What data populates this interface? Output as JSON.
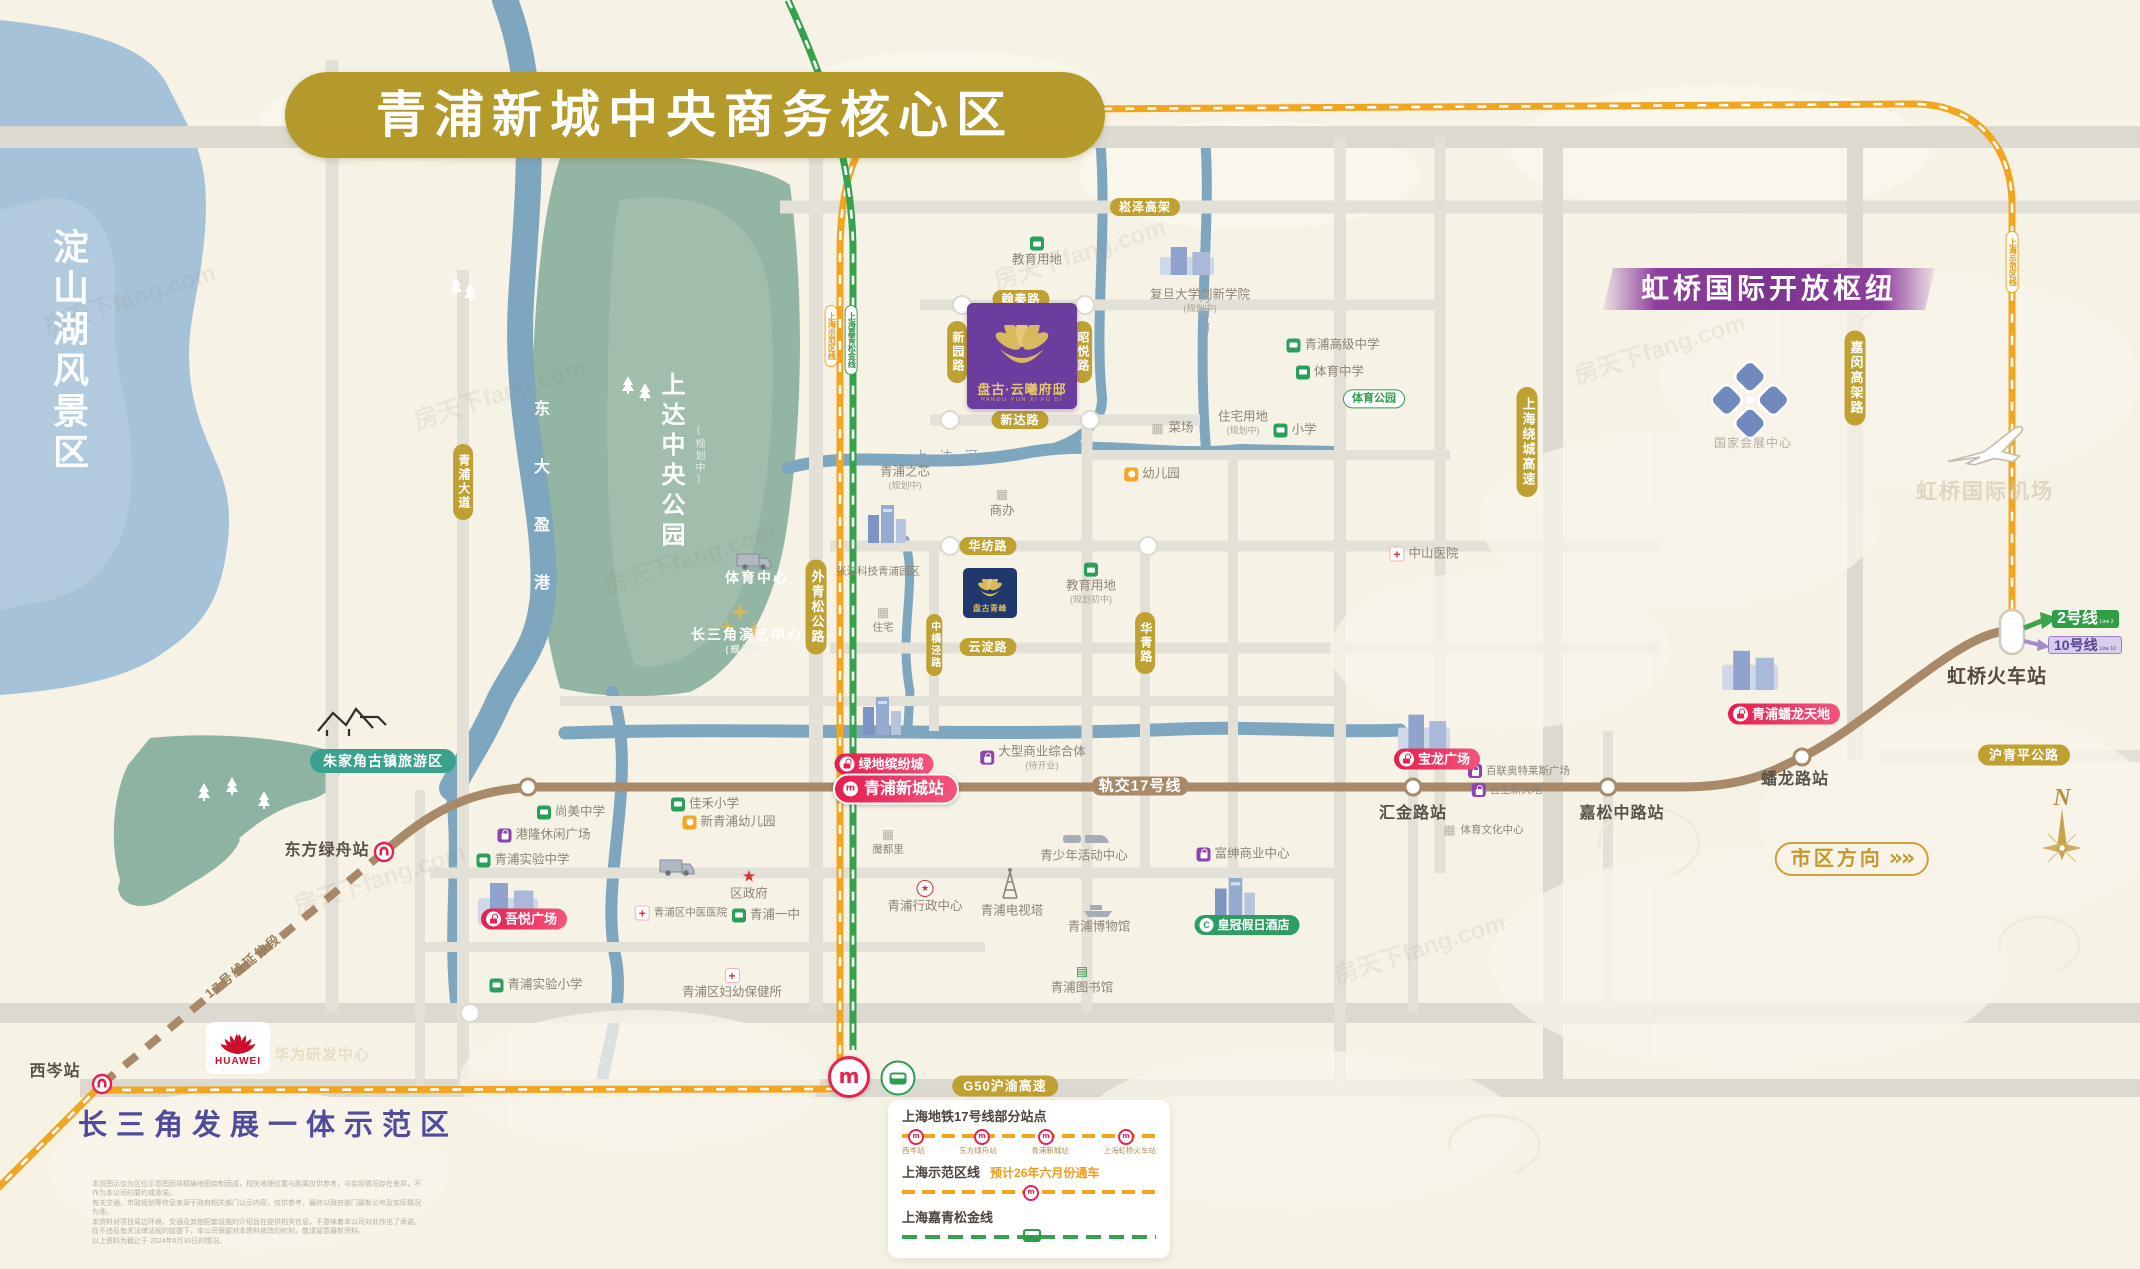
{
  "title": "青浦新城中央商务核心区",
  "banners": {
    "hongqiao": "虹桥国际开放枢纽",
    "demo_zone": "长三角发展一体示范区",
    "lake": "淀山湖风景区",
    "city_direction": "市区方向",
    "chevrons": "»»"
  },
  "colors": {
    "title_gold": "#b4992b",
    "line17_brown": "#a8896a",
    "sfq_orange": "#f2a51f",
    "jqsj_green": "#35a24e",
    "red_pill": "#e61e4e",
    "banner_purple": "#8e3f9e",
    "project_purple": "#6a3d9e",
    "project_navy": "#20386b"
  },
  "blocks": {
    "pangu_mansion": {
      "name": "盘古·云曦府邸",
      "latin": "PANGU YUN XI FU DI"
    },
    "pangu_peak": {
      "name": "盘古青峰"
    }
  },
  "transit": {
    "line2": {
      "label": "2号线",
      "sub": "Line 2"
    },
    "line10": {
      "label": "10号线",
      "sub": "Line 10"
    }
  },
  "compass": {
    "n": "N"
  },
  "watermark": "房天下fang.com",
  "huawei": "HUAWEI",
  "legend": {
    "line17": {
      "title": "上海地铁17号线部分站点",
      "stations": [
        "西岑站",
        "东方绿舟站",
        "青浦新城站",
        "上海虹桥火车站"
      ]
    },
    "sfq": {
      "title": "上海示范区线",
      "note": "预计26年六月份通车"
    },
    "jqsj": {
      "title": "上海嘉青松金线"
    }
  },
  "labels": [
    {
      "name": "songze-elevated-label",
      "text": "崧泽高架",
      "x": 1145,
      "y": 207,
      "cls": "gold sm"
    },
    {
      "name": "hanqin-road-label",
      "text": "翰秦路",
      "x": 1021,
      "y": 299,
      "cls": "gold sm"
    },
    {
      "name": "xinyuan-road-label",
      "text": "新园路",
      "x": 957,
      "y": 352,
      "cls": "goldv sm"
    },
    {
      "name": "zhaoyue-road-label",
      "text": "昭悦路",
      "x": 1082,
      "y": 352,
      "cls": "goldv sm"
    },
    {
      "name": "xinda-road-label",
      "text": "新达路",
      "x": 1020,
      "y": 420,
      "cls": "gold sm"
    },
    {
      "name": "qingpu-avenue-label",
      "text": "青浦大道",
      "x": 463,
      "y": 482,
      "cls": "goldv sm"
    },
    {
      "name": "waiqingsong-highway-label",
      "text": "外青松公路",
      "x": 816,
      "y": 607,
      "cls": "goldv"
    },
    {
      "name": "zhonghengjing-road-label",
      "text": "中横泾路",
      "x": 934,
      "y": 645,
      "cls": "goldv xs"
    },
    {
      "name": "huafang-road-label",
      "text": "华纺路",
      "x": 988,
      "y": 546,
      "cls": "gold sm"
    },
    {
      "name": "yundian-road-label",
      "text": "云淀路",
      "x": 988,
      "y": 647,
      "cls": "gold sm"
    },
    {
      "name": "huaqing-road-label",
      "text": "华青路",
      "x": 1145,
      "y": 643,
      "cls": "goldv sm"
    },
    {
      "name": "raocheng-expressway-label",
      "text": "上海绕城高速",
      "x": 1527,
      "y": 442,
      "cls": "goldv"
    },
    {
      "name": "jiamin-elevated-label",
      "text": "嘉闵高架路",
      "x": 1855,
      "y": 378,
      "cls": "goldv"
    },
    {
      "name": "huqingping-highway-label",
      "text": "沪青平公路",
      "x": 2024,
      "y": 755,
      "cls": "gold"
    },
    {
      "name": "g50-expressway-label",
      "text": "G50沪渝高速",
      "x": 1005,
      "y": 1086,
      "cls": "gold"
    },
    {
      "name": "zhujiajiao-area-pill",
      "text": "朱家角古镇旅游区",
      "x": 383,
      "y": 761,
      "cls": "teal"
    },
    {
      "name": "lvdi-mall-pill",
      "text": "绿地缤纷城",
      "x": 884,
      "y": 764,
      "cls": "red",
      "icon": "bagw"
    },
    {
      "name": "xincheng-station-pill",
      "text": "青浦新城站",
      "x": 896,
      "y": 789,
      "cls": "red lg",
      "icon": "rdl"
    },
    {
      "name": "wuyue-mall-pill",
      "text": "吾悦广场",
      "x": 524,
      "y": 919,
      "cls": "red",
      "icon": "bagw"
    },
    {
      "name": "baolong-mall-pill",
      "text": "宝龙广场",
      "x": 1437,
      "y": 759,
      "cls": "red",
      "icon": "bagw"
    },
    {
      "name": "panlong-tiandi-pill",
      "text": "青浦蟠龙天地",
      "x": 1784,
      "y": 714,
      "cls": "red",
      "icon": "bagw"
    },
    {
      "name": "crowne-plaza-pill",
      "text": "皇冠假日酒店",
      "x": 1247,
      "y": 925,
      "cls": "greenpill",
      "icon": "cw"
    },
    {
      "name": "sfq-line-pill-left",
      "text": "上海示范区线",
      "x": 831,
      "y": 336,
      "cls": "lpill o"
    },
    {
      "name": "jqsj-line-pill",
      "text": "上海嘉青松金线",
      "x": 851,
      "y": 340,
      "cls": "lpill g"
    },
    {
      "name": "sfq-line-pill-right",
      "text": "上海示范区线",
      "x": 2012,
      "y": 262,
      "cls": "lpill o"
    },
    {
      "name": "xicen-station-label",
      "text": "西岑站",
      "x": 55,
      "y": 1072,
      "cls": "sta"
    },
    {
      "name": "dongfanglvzhou-station-label",
      "text": "东方绿舟站",
      "x": 327,
      "y": 851,
      "cls": "sta"
    },
    {
      "name": "huijin-station-label",
      "text": "汇金路站",
      "x": 1413,
      "y": 814,
      "cls": "sta"
    },
    {
      "name": "jiasongzhong-station-label",
      "text": "嘉松中路站",
      "x": 1622,
      "y": 814,
      "cls": "sta"
    },
    {
      "name": "panlonglu-station-label",
      "text": "蟠龙路站",
      "x": 1795,
      "y": 780,
      "cls": "sta"
    },
    {
      "name": "hongqiao-railway-station-label",
      "text": "虹桥火车站",
      "x": 1997,
      "y": 677,
      "cls": "sta lg"
    },
    {
      "name": "line17-on-map-label",
      "text": "轨交17号线",
      "x": 1140,
      "y": 786,
      "cls": "online"
    },
    {
      "name": "line17-extension-label",
      "text": "17号线延伸段",
      "x": 243,
      "y": 966,
      "cls": "ext",
      "rot": -39
    },
    {
      "name": "dianshan-lake-label",
      "text": "淀山湖风景区",
      "x": 68,
      "y": 228,
      "cls": "lakev topanch"
    },
    {
      "name": "shangda-park-label",
      "text": "上达中央公园",
      "x": 670,
      "y": 372,
      "cls": "parkv topanch"
    },
    {
      "name": "shangda-park-plan-label",
      "text": "(规划中)",
      "x": 698,
      "y": 425,
      "cls": "parksub topanch"
    },
    {
      "name": "dongdayinggang-river-label",
      "text": "东大盈港",
      "x": 539,
      "y": 400,
      "cls": "riverv topanch"
    },
    {
      "name": "changsanjiao-zone-label",
      "text": "长三角发展一体示范区",
      "x": 268,
      "y": 1126,
      "cls": "zone"
    },
    {
      "name": "hongqiao-airport-faint-label",
      "text": "虹桥国际机场",
      "x": 1985,
      "y": 492,
      "cls": "faint"
    },
    {
      "name": "huawei-rd-faint-label",
      "text": "华为研发中心",
      "x": 322,
      "y": 1055,
      "cls": "faint2"
    },
    {
      "name": "huawei-logo-word",
      "text": "HUAWEI",
      "x": 238,
      "y": 1062,
      "cls": "huaweiword"
    },
    {
      "name": "shangdahe-river-label",
      "text": "上达河",
      "x": 952,
      "y": 456,
      "cls": "grayriv"
    },
    {
      "name": "mianyanghe-river-label",
      "text": "沔阳河",
      "x": 1203,
      "y": 292,
      "cls": "rivv topanch"
    },
    {
      "name": "necc-label",
      "text": "国家会展中心",
      "x": 1753,
      "y": 443,
      "cls": "plaingray"
    }
  ],
  "pois": [
    {
      "name": "poi-education-land-1",
      "text": "教育用地",
      "x": 1037,
      "y": 252,
      "icon": "school",
      "layout": "col"
    },
    {
      "name": "poi-fudan-innovation",
      "text": "复旦大学创新学院",
      "x": 1200,
      "y": 301,
      "icon": "none",
      "layout": "col",
      "sub": "(规划中)"
    },
    {
      "name": "poi-qingpu-zhixin",
      "text": "青浦之芯",
      "x": 905,
      "y": 478,
      "icon": "none",
      "layout": "col",
      "sub": "(规划中)"
    },
    {
      "name": "poi-qingpu-senior-high",
      "text": "青浦高级中学",
      "x": 1333,
      "y": 345,
      "icon": "school",
      "layout": "row"
    },
    {
      "name": "poi-tiyu-middle-school",
      "text": "体育中学",
      "x": 1330,
      "y": 372,
      "icon": "school",
      "layout": "row"
    },
    {
      "name": "poi-sports-park",
      "text": "体育公园",
      "x": 1374,
      "y": 399,
      "icon": "none",
      "layout": "row",
      "cls": "greenmini"
    },
    {
      "name": "poi-market",
      "text": "菜场",
      "x": 1172,
      "y": 428,
      "icon": "bldg",
      "layout": "row"
    },
    {
      "name": "poi-residential-land",
      "text": "住宅用地",
      "x": 1243,
      "y": 423,
      "icon": "none",
      "layout": "col",
      "sub": "(规划中)"
    },
    {
      "name": "poi-primary-school",
      "text": "小学",
      "x": 1295,
      "y": 430,
      "icon": "school",
      "layout": "row"
    },
    {
      "name": "poi-kindergarten",
      "text": "幼儿园",
      "x": 1152,
      "y": 474,
      "icon": "kind",
      "layout": "row"
    },
    {
      "name": "poi-office",
      "text": "商办",
      "x": 1002,
      "y": 503,
      "icon": "bldg",
      "layout": "col"
    },
    {
      "name": "poi-residence",
      "text": "住宅",
      "x": 883,
      "y": 620,
      "icon": "bldg",
      "layout": "col",
      "cls": "xs"
    },
    {
      "name": "poi-education-land-2",
      "text": "教育用地",
      "x": 1091,
      "y": 584,
      "icon": "school",
      "layout": "col",
      "sub": "(规划初中)"
    },
    {
      "name": "poi-zhangjiang-park",
      "text": "张江科技青浦园区",
      "x": 878,
      "y": 572,
      "icon": "none",
      "layout": "row",
      "cls": "xs"
    },
    {
      "name": "poi-sports-center",
      "text": "体育中心",
      "x": 757,
      "y": 578,
      "icon": "none",
      "layout": "row",
      "cls": "white"
    },
    {
      "name": "poi-yanyi-center",
      "text": "长三角演艺中心",
      "x": 747,
      "y": 641,
      "icon": "none",
      "layout": "col",
      "sub": "(规划中)",
      "cls": "white"
    },
    {
      "name": "poi-shangmei-middle",
      "text": "尚美中学",
      "x": 571,
      "y": 812,
      "icon": "school",
      "layout": "row"
    },
    {
      "name": "poi-ganglong-plaza",
      "text": "港隆休闲广场",
      "x": 544,
      "y": 835,
      "icon": "shopp",
      "layout": "row"
    },
    {
      "name": "poi-qingpu-exp-middle",
      "text": "青浦实验中学",
      "x": 523,
      "y": 860,
      "icon": "school",
      "layout": "row"
    },
    {
      "name": "poi-jiahe-primary",
      "text": "佳禾小学",
      "x": 705,
      "y": 804,
      "icon": "school",
      "layout": "row"
    },
    {
      "name": "poi-new-qingpu-kind",
      "text": "新青浦幼儿园",
      "x": 729,
      "y": 822,
      "icon": "kind",
      "layout": "row"
    },
    {
      "name": "poi-district-gov",
      "text": "区政府",
      "x": 749,
      "y": 886,
      "icon": "star",
      "layout": "col"
    },
    {
      "name": "poi-tcm-hospital",
      "text": "青浦区中医医院",
      "x": 681,
      "y": 913,
      "icon": "hosp",
      "layout": "row",
      "cls": "xs"
    },
    {
      "name": "poi-qingpu-no1-middle",
      "text": "青浦一中",
      "x": 766,
      "y": 915,
      "icon": "school",
      "layout": "row"
    },
    {
      "name": "poi-maternal-care",
      "text": "青浦区妇幼保健所",
      "x": 732,
      "y": 984,
      "icon": "hosp",
      "layout": "col"
    },
    {
      "name": "poi-qingpu-exp-primary",
      "text": "青浦实验小学",
      "x": 536,
      "y": 985,
      "icon": "school",
      "layout": "row"
    },
    {
      "name": "poi-moduli",
      "text": "魔都里",
      "x": 888,
      "y": 842,
      "icon": "bldg",
      "layout": "col",
      "cls": "xs"
    },
    {
      "name": "poi-admin-center",
      "text": "青浦行政中心",
      "x": 925,
      "y": 897,
      "icon": "starc",
      "layout": "col"
    },
    {
      "name": "poi-tv-tower",
      "text": "青浦电视塔",
      "x": 1012,
      "y": 911,
      "icon": "none",
      "layout": "col"
    },
    {
      "name": "poi-youth-center",
      "text": "青少年活动中心",
      "x": 1084,
      "y": 856,
      "icon": "none",
      "layout": "col"
    },
    {
      "name": "poi-museum",
      "text": "青浦博物馆",
      "x": 1099,
      "y": 927,
      "icon": "none",
      "layout": "col"
    },
    {
      "name": "poi-library",
      "text": "青浦图书馆",
      "x": 1082,
      "y": 980,
      "icon": "lib",
      "layout": "col"
    },
    {
      "name": "poi-fushen-center",
      "text": "富绅商业中心",
      "x": 1243,
      "y": 854,
      "icon": "shopp",
      "layout": "row"
    },
    {
      "name": "poi-zhongshan-hospital",
      "text": "中山医院",
      "x": 1424,
      "y": 554,
      "icon": "hosp",
      "layout": "row"
    },
    {
      "name": "poi-mega-mall",
      "text": "大型商业综合体",
      "x": 1033,
      "y": 758,
      "icon": "shopp",
      "layout": "row",
      "sub": "(待开业)"
    },
    {
      "name": "poi-bailian-outlets",
      "text": "百联奥特莱斯广场",
      "x": 1519,
      "y": 771,
      "icon": "shopp",
      "layout": "row",
      "cls": "xs"
    },
    {
      "name": "poi-hesheng-xintiandi",
      "text": "合生新天地",
      "x": 1507,
      "y": 790,
      "icon": "shopp",
      "layout": "row",
      "cls": "xs"
    },
    {
      "name": "poi-sports-culture-center",
      "text": "体育文化中心",
      "x": 1483,
      "y": 830,
      "icon": "bldg",
      "layout": "row",
      "cls": "xs"
    }
  ],
  "disclaimer": [
    "本页图示仅为区位示意图而非精确地图绘制而成，相关地理位置与距离仅供参考，与实际情况存在差异，不作为本公司的要约或承诺。",
    "有关交通、市政规划等信息来源于政府相关部门公示内容，仅供参考，最终以政府部门最新公布及实际情况为准。",
    "本资料对项目周边环境、交通及其他配套设施的介绍旨在提供相关信息，不意味着本公司对此作出了承诺。",
    "在不违反有关法律法规的前提下，本公司保留对本资料修改的权利，敬请留意最新资料。",
    "以上资料为截止于 2024年6月30日的情况。"
  ]
}
